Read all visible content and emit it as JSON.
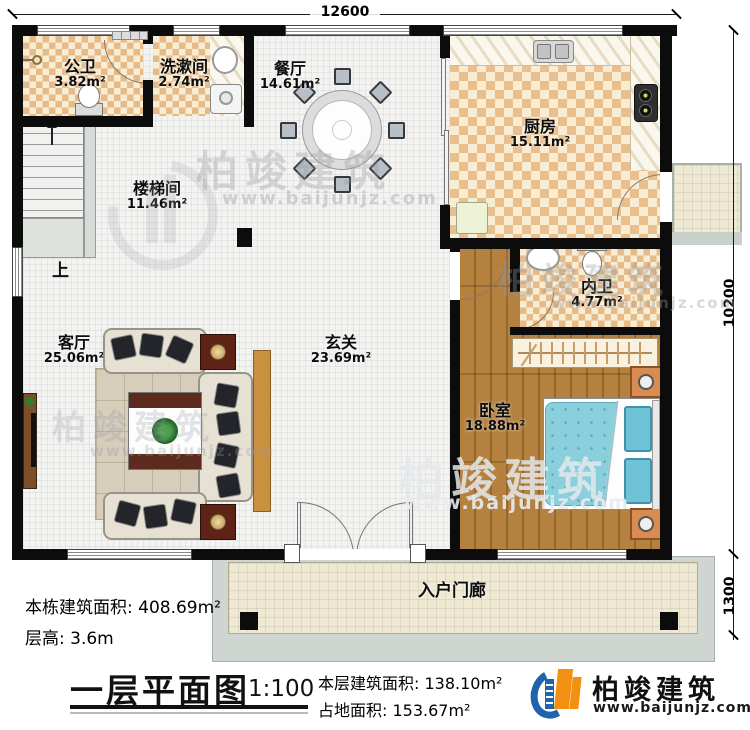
{
  "dimensions": {
    "width_total": "12600",
    "height_main": "10200",
    "porch_depth": "1300"
  },
  "rooms": {
    "gongwei": {
      "name": "公卫",
      "area": "3.82m²"
    },
    "xishujian": {
      "name": "洗漱间",
      "area": "2.74m²"
    },
    "canting": {
      "name": "餐厅",
      "area": "14.61m²"
    },
    "chufang": {
      "name": "厨房",
      "area": "15.11m²"
    },
    "loutijian": {
      "name": "楼梯间",
      "area": "11.46m²"
    },
    "neiwei": {
      "name": "内卫",
      "area": "4.77m²"
    },
    "keting": {
      "name": "客厅",
      "area": "25.06m²"
    },
    "xuanguan": {
      "name": "玄关",
      "area": "23.69m²"
    },
    "woshi": {
      "name": "卧室",
      "area": "18.88m²"
    },
    "menlang": {
      "name": "入户门廊"
    }
  },
  "stairs": {
    "up": "上"
  },
  "title_block": {
    "building_total_area": "本栋建筑面积: 408.69m²",
    "floor_height": "层高: 3.6m",
    "plan_title": "一层平面图",
    "scale": "1:100",
    "floor_area": "本层建筑面积: 138.10m²",
    "footprint_area": "占地面积: 153.67m²"
  },
  "brand": {
    "name": "柏竣建筑",
    "website": "www.baijunjz.com"
  },
  "watermark": {
    "name": "柏竣建筑",
    "website": "www.baijunjz.com"
  },
  "colors": {
    "wall": "#0c0c0c",
    "tile_dark": "#e6bb8a",
    "tile_light": "#f8ecd2",
    "wood": "#b5813f",
    "bed_blue": "#8bcfdd",
    "brand_blue": "#1d64ad",
    "brand_orange": "#f29111"
  }
}
